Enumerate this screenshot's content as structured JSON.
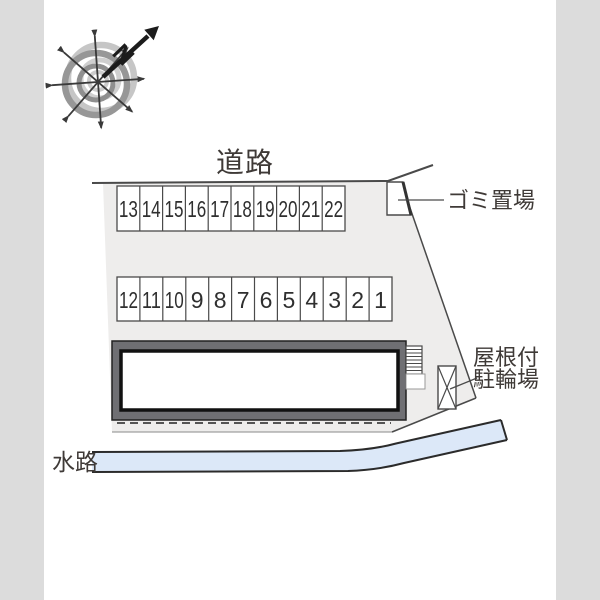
{
  "compass": {
    "north": "N"
  },
  "labels": {
    "road": "道路",
    "garbage": "ゴミ置場",
    "bicycle_line1": "屋根付",
    "bicycle_line2": "駐輪場",
    "waterway": "水路"
  },
  "parking": {
    "row1": [
      "13",
      "14",
      "15",
      "16",
      "17",
      "18",
      "19",
      "20",
      "21",
      "22"
    ],
    "row2": [
      "12",
      "11",
      "10",
      "9",
      "8",
      "7",
      "6",
      "5",
      "4",
      "3",
      "2",
      "1"
    ]
  },
  "colors": {
    "side_band": "#dcdcdc",
    "plot_fill": "#eeedec",
    "stall_fill": "#ffffff",
    "building_band": "#6f6f73",
    "building_inner": "#ffffff",
    "waterway_fill": "#dce8f8",
    "line": "#4a4a4a"
  }
}
